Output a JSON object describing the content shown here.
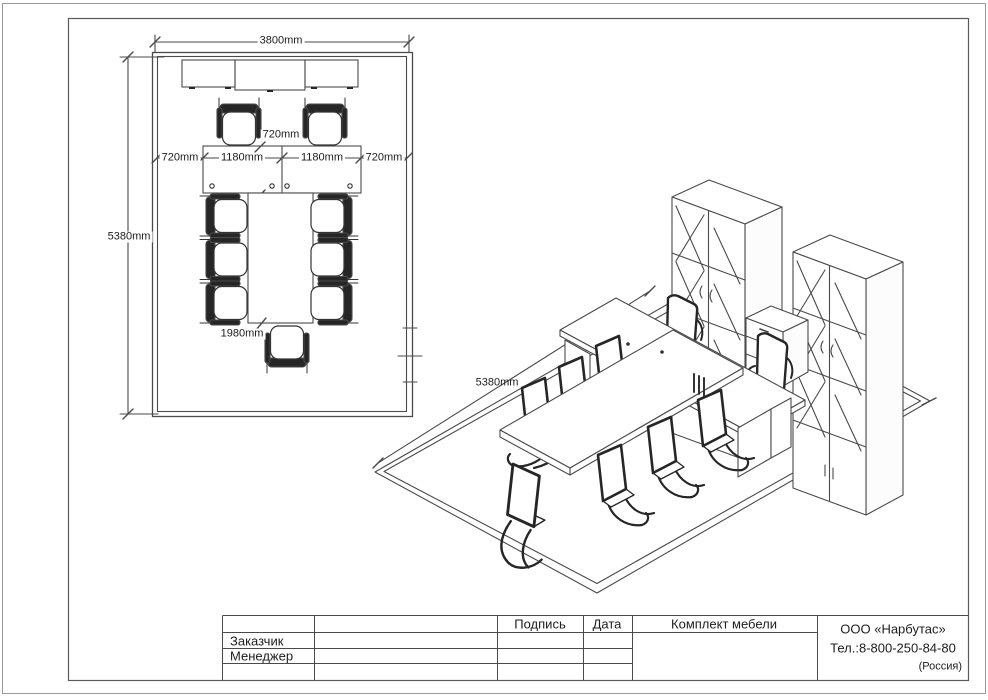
{
  "plan": {
    "width_dim": "3800mm",
    "height_dim": "5380mm",
    "left_clearance_dim": "720mm",
    "desk1_dim": "1180mm",
    "desk2_dim": "1180mm",
    "right_clearance_dim": "720mm",
    "desk_depth_dim": "720mm",
    "table_length_dim": "1980mm"
  },
  "iso": {
    "depth_dim": "5380mm"
  },
  "title_block": {
    "signature": "Подпись",
    "date": "Дата",
    "project": "Комплект мебели",
    "customer": "Заказчик",
    "manager": "Менеджер",
    "company": "ООО «Нарбутас»",
    "phone": "Тел.:8-800-250-84-80",
    "country": "(Россия)"
  },
  "colors": {
    "line": "#4a4a4a",
    "ink": "#1d1d1d",
    "frame": "#9b9b9b",
    "fill_dark": "#262626"
  }
}
